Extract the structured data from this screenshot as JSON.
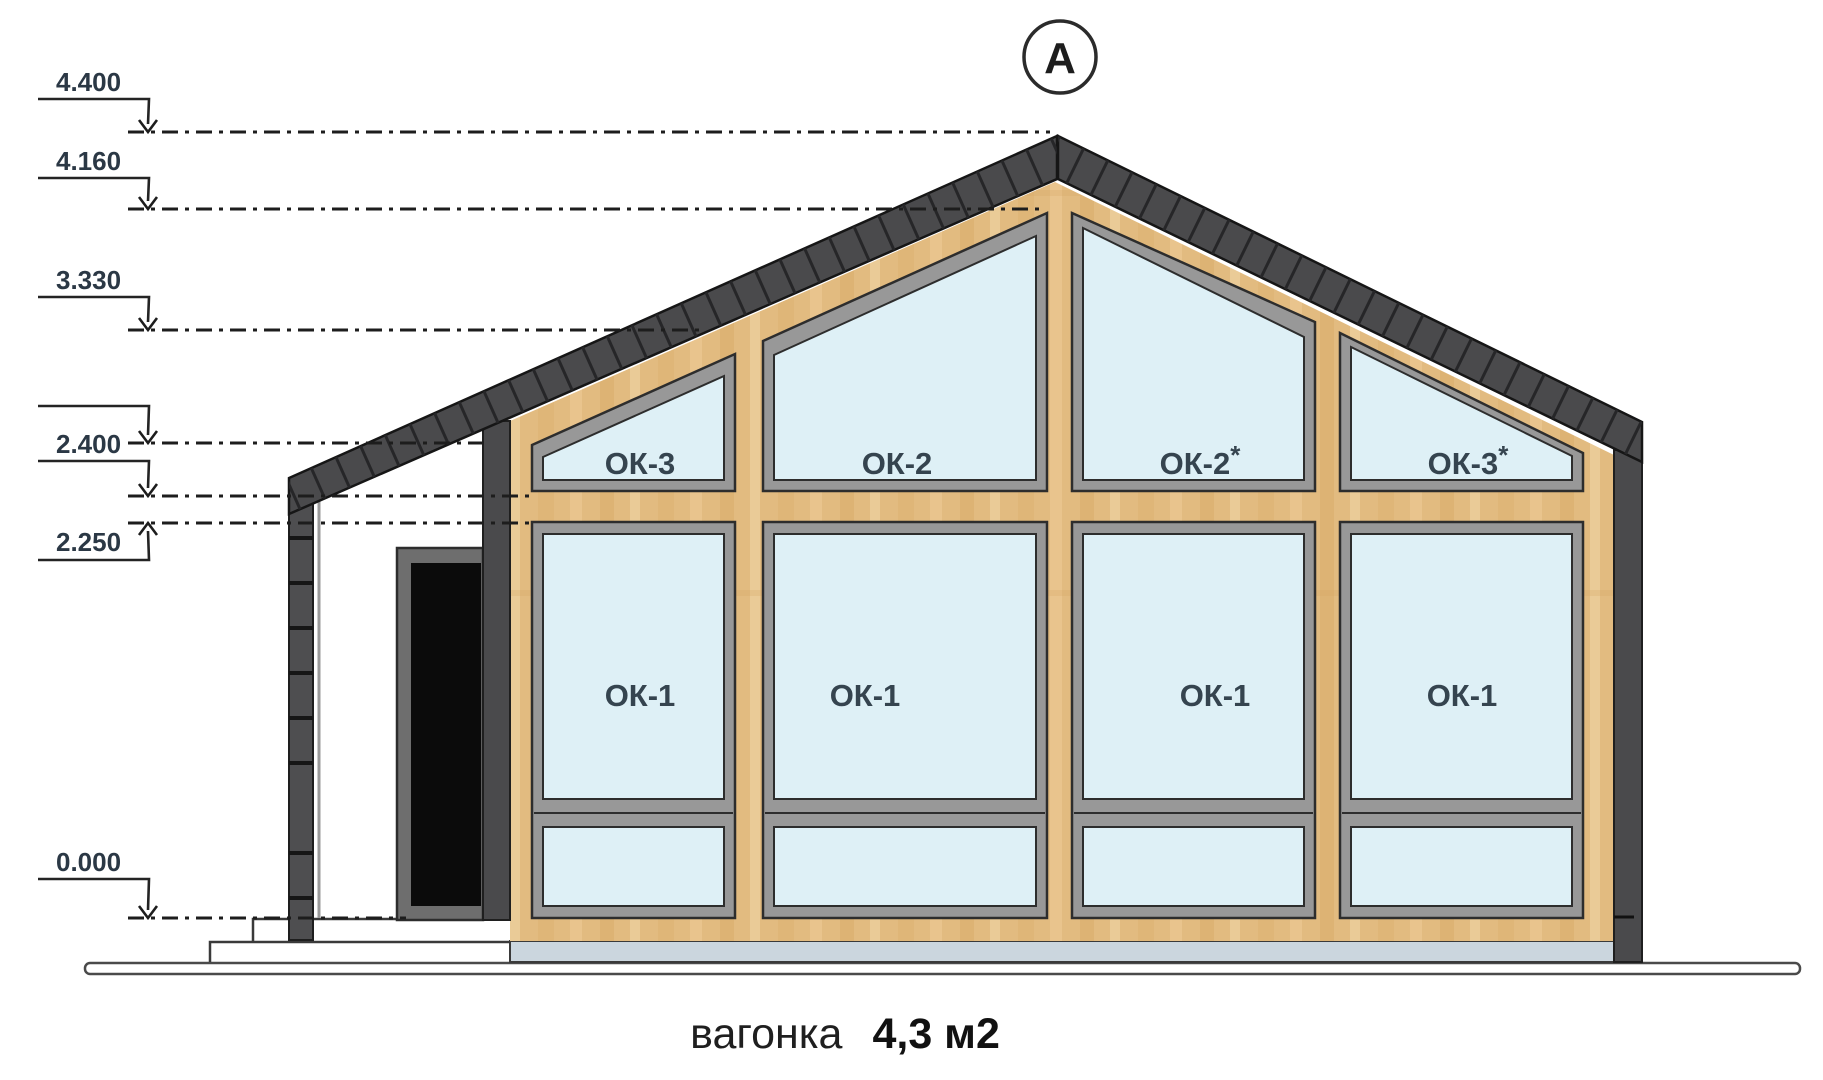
{
  "axis": {
    "label": "А"
  },
  "elevation_marks": {
    "marks": [
      {
        "label": "4.400"
      },
      {
        "label": "4.160"
      },
      {
        "label": "3.330"
      },
      {
        "label": "2.400"
      },
      {
        "label": "2.250"
      },
      {
        "label": "0.000"
      }
    ]
  },
  "windows": {
    "upper": [
      {
        "label": "ОК-3",
        "sup": ""
      },
      {
        "label": "ОК-2",
        "sup": ""
      },
      {
        "label": "ОК-2",
        "sup": "*"
      },
      {
        "label": "ОК-3",
        "sup": "*"
      }
    ],
    "lower": [
      {
        "label": "ОК-1"
      },
      {
        "label": "ОК-1"
      },
      {
        "label": "ОК-1"
      },
      {
        "label": "ОК-1"
      }
    ]
  },
  "caption": {
    "material": "вагонка",
    "area": "4,3 м2"
  },
  "colors": {
    "roof": "#4a4a4c",
    "wood": "#e2bb80",
    "glass": "#def0f6",
    "frame": "#989898",
    "slab": "#cbd6de",
    "ink": "#2b3845"
  }
}
